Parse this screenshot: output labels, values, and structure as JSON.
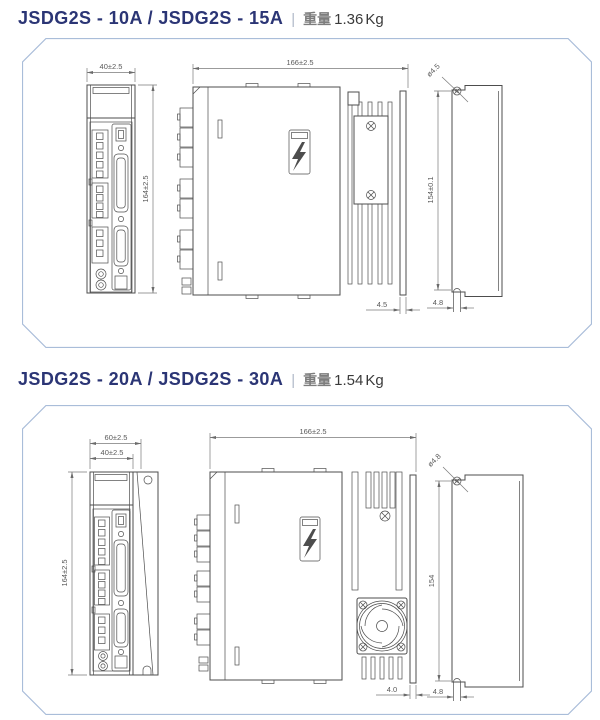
{
  "colors": {
    "title_navy": "#2b3575",
    "separator_gray": "#b0b8c8",
    "weight_gray": "#7d7d7d",
    "value_dark": "#3a3a3a",
    "panel_border": "#a9bdd9",
    "line": "#4d4d4d",
    "dim_text": "#5a5a5a"
  },
  "sections": [
    {
      "title_model": "JSDG2S - 10A / JSDG2S - 15A",
      "separator": "|",
      "weight_label": "重量",
      "weight_value": "1.36",
      "weight_unit": "Kg",
      "dims": {
        "front_width": "40±2.5",
        "front_height": "164±2.5",
        "side_width": "166±2.5",
        "side_gap": "4.5",
        "back_hole_dia": "ø4.5",
        "back_height": "154±0.1",
        "back_slot_width": "4.8"
      }
    },
    {
      "title_model": "JSDG2S - 20A / JSDG2S - 30A",
      "separator": "|",
      "weight_label": "重量",
      "weight_value": "1.54",
      "weight_unit": "Kg",
      "dims": {
        "front_width_outer": "60±2.5",
        "front_width": "40±2.5",
        "front_height": "164±2.5",
        "side_width": "166±2.5",
        "side_gap": "4.0",
        "back_hole_dia": "ø4.8",
        "back_height": "154",
        "back_slot_width": "4.8"
      }
    }
  ]
}
